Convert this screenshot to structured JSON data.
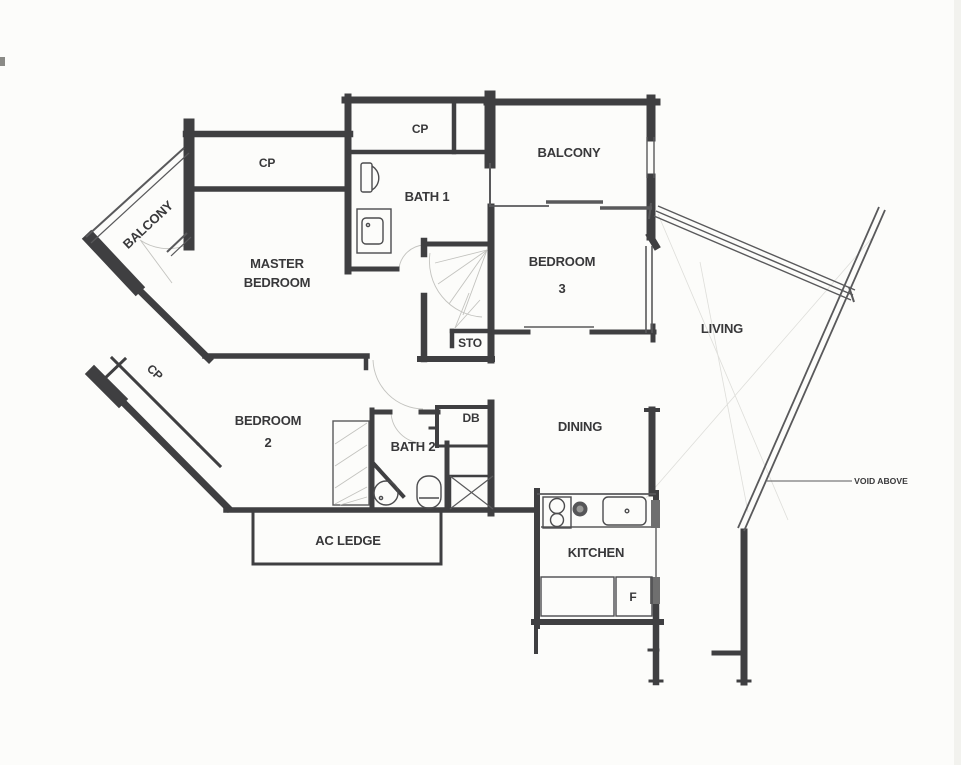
{
  "plan": {
    "title": "apartment-floor-plan",
    "rooms": {
      "cp_top_left": {
        "label": "CP"
      },
      "balcony_left": {
        "label": "BALCONY"
      },
      "cp_top": {
        "label": "CP"
      },
      "bath1": {
        "label": "BATH 1"
      },
      "balcony_right": {
        "label": "BALCONY"
      },
      "master_bedroom": {
        "line1": "MASTER",
        "line2": "BEDROOM"
      },
      "bedroom3": {
        "line1": "BEDROOM",
        "line2": "3"
      },
      "living": {
        "label": "LIVING"
      },
      "sto": {
        "label": "STO"
      },
      "cp_mid_left": {
        "label": "CP"
      },
      "bedroom2": {
        "line1": "BEDROOM",
        "line2": "2"
      },
      "bath2": {
        "label": "BATH 2"
      },
      "db": {
        "label": "DB"
      },
      "dining": {
        "label": "DINING"
      },
      "ac_ledge": {
        "label": "AC LEDGE"
      },
      "kitchen": {
        "label": "KITCHEN"
      },
      "fridge": {
        "label": "F"
      },
      "void_above": {
        "label": "VOID ABOVE"
      }
    },
    "colors": {
      "wall": "#3f3f41",
      "thin_wall": "#59595b",
      "paper": "#fcfcfa",
      "label": "#38383a",
      "faint": "#c3c3bf"
    }
  }
}
